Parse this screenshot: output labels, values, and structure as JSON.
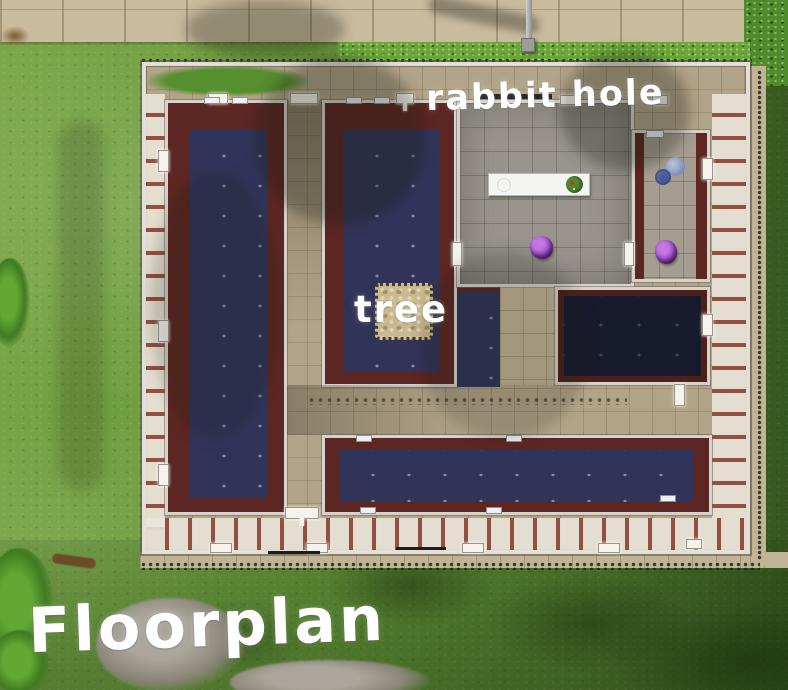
{
  "labels": {
    "rabbit_hole": "rabbit hole",
    "tree": "tree",
    "title": "Floorplan"
  },
  "objects": [
    "lamp-post",
    "white-counter-with-flower-arrangement",
    "purple-flower-bush-left",
    "purple-flower-bush-right",
    "blue-water-basin",
    "tree-dirt-patch"
  ],
  "colors": {
    "grass": "#5d8c34",
    "grass_dark": "#3f6a26",
    "sidewalk_tan": "#c9bb9d",
    "walkway_tan": "#b2a489",
    "corridor_tile": "#c3b496",
    "wall_white": "#e3dfd6",
    "carpet_border_maroon": "#5c2623",
    "carpet_navy": "#313459",
    "carpet_dark_navy": "#181a2e",
    "tile_gray": "#99958d",
    "counter_white": "#f4f4f2",
    "plant_purple": "#9a4fc4",
    "basin_blue": "#7f93c2",
    "dirt_patch_tan": "#c9b990",
    "label_text": "#ffffff"
  }
}
